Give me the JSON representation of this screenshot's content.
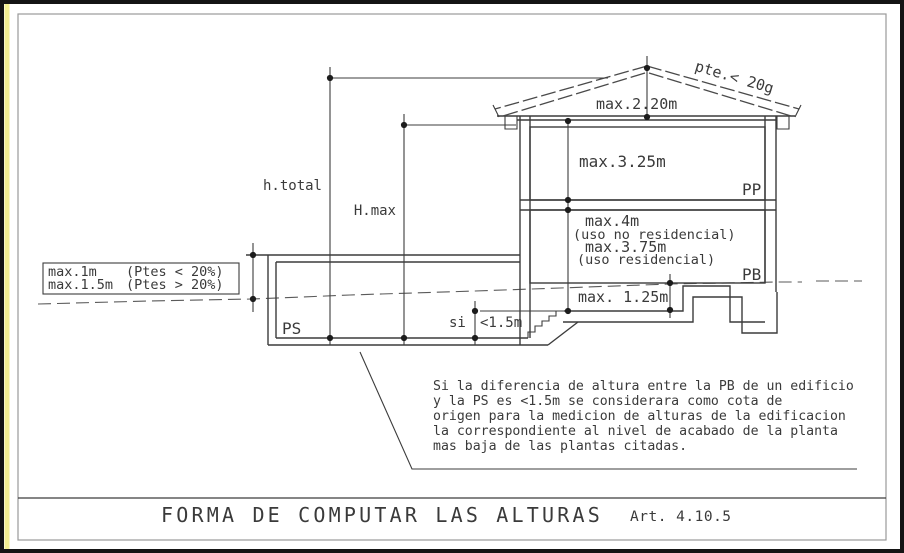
{
  "title_bar": {
    "title": "FORMA DE COMPUTAR LAS ALTURAS",
    "article": "Art. 4.10.5"
  },
  "drawing": {
    "roof": {
      "slope_label": "pte.< 20g",
      "ridge_height": "max.2.20m"
    },
    "floors": {
      "pp_label": "PP",
      "pp_height": "max.3.25m",
      "pb_label": "PB",
      "pb_height_nonres": "max.4m",
      "pb_nonres_note": "(uso no residencial)",
      "pb_height_res": "max.3.75m",
      "pb_res_note": "(uso residencial)",
      "pb_below_dim": "max. 1.25m",
      "ps_label": "PS"
    },
    "dims": {
      "h_total": "h.total",
      "h_max": "H.max",
      "si_prefix": "si",
      "si_value": "<1.5m"
    },
    "ground_box": {
      "row1_value": "max.1m",
      "row1_cond": "(Ptes < 20%)",
      "row2_value": "max.1.5m",
      "row2_cond": "(Ptes > 20%)"
    },
    "note_lines": [
      "Si la diferencia de altura entre la PB de un edificio",
      "y la PS es <1.5m  se considerara como cota de",
      "origen para la medicion de alturas de la edificacion",
      "la correspondiente al nivel de acabado de la planta",
      "mas baja de las plantas citadas."
    ]
  },
  "colors": {
    "line": "#3c3c3c",
    "accent_strip": "#f3ef92",
    "frame": "#141414"
  }
}
